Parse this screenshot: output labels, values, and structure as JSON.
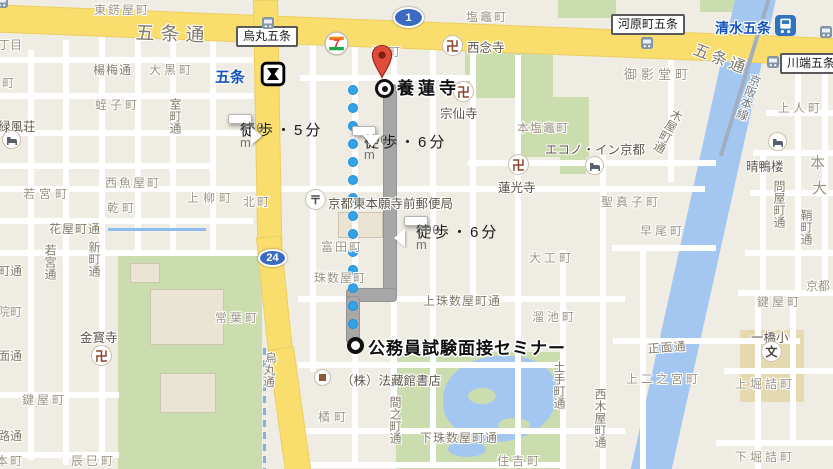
{
  "route": {
    "origin": {
      "label": "公務員試験面接セミナー",
      "x": 368,
      "y": 334
    },
    "destination": {
      "label": "養蓮寺",
      "x": 397,
      "y": 74
    },
    "walk_boxes": [
      {
        "duration": "徒歩・5分",
        "distance": "450 m",
        "x": 228,
        "y": 114,
        "ptr": "right"
      },
      {
        "duration": "徒歩・6分",
        "distance": "500 m",
        "x": 352,
        "y": 126,
        "ptr": "down"
      },
      {
        "duration": "徒歩・6分",
        "distance": "500 m",
        "x": 404,
        "y": 216,
        "ptr": "left"
      }
    ],
    "dots": {
      "x": 353,
      "y1": 90,
      "y2": 338,
      "step": 18
    },
    "gray_segments": [
      {
        "x": 383,
        "y": 84,
        "w": 14,
        "h": 216
      },
      {
        "x": 346,
        "y": 288,
        "w": 51,
        "h": 14
      },
      {
        "x": 346,
        "y": 296,
        "w": 14,
        "h": 48
      }
    ]
  },
  "map": {
    "road_shields": [
      {
        "num": "1",
        "x": 393,
        "y": 7,
        "w": 31,
        "h": 21
      },
      {
        "num": "24",
        "x": 258,
        "y": 249,
        "w": 29,
        "h": 18
      }
    ],
    "transit_labels": [
      {
        "t": "五条",
        "x": 215,
        "y": 66,
        "fs": 15
      },
      {
        "t": "清水五条",
        "x": 715,
        "y": 18,
        "fs": 14
      }
    ],
    "transit_boxes": [
      {
        "t": "烏丸五条",
        "x": 236,
        "y": 26
      },
      {
        "t": "河原町五条",
        "x": 611,
        "y": 14
      },
      {
        "t": "川端五条",
        "x": 780,
        "y": 53
      }
    ],
    "town_labels": [
      {
        "t": "東錺屋町",
        "x": 94,
        "y": 1,
        "ls": 2
      },
      {
        "t": "丁目",
        "x": -2,
        "y": 36
      },
      {
        "t": "町",
        "x": 2,
        "y": 74
      },
      {
        "t": "大黒町",
        "x": 149,
        "y": 61,
        "ls": 3
      },
      {
        "t": "蛭子町",
        "x": 95,
        "y": 96,
        "ls": 3
      },
      {
        "t": "津町",
        "x": 372,
        "y": 43,
        "ls": 4
      },
      {
        "t": "塩竈町",
        "x": 466,
        "y": 8,
        "ls": 2
      },
      {
        "t": "御影堂町",
        "x": 624,
        "y": 64,
        "fs": 13,
        "ls": 4
      },
      {
        "t": "上人町",
        "x": 778,
        "y": 99,
        "ls": 3
      },
      {
        "t": "本塩竈町",
        "x": 517,
        "y": 119,
        "ls": 1
      },
      {
        "t": "若宮町",
        "x": 23,
        "y": 185,
        "ls": 4
      },
      {
        "t": "西魚屋町",
        "x": 105,
        "y": 174,
        "ls": 2
      },
      {
        "t": "乾町",
        "x": 107,
        "y": 199,
        "ls": 3
      },
      {
        "t": "上柳町",
        "x": 187,
        "y": 189,
        "ls": 4
      },
      {
        "t": "北町",
        "x": 243,
        "y": 193,
        "ls": 2
      },
      {
        "t": "聖真子町",
        "x": 601,
        "y": 193,
        "ls": 3
      },
      {
        "t": "早尾町",
        "x": 640,
        "y": 222,
        "ls": 3
      },
      {
        "t": "大工町",
        "x": 529,
        "y": 249,
        "ls": 3
      },
      {
        "t": "富田町",
        "x": 321,
        "y": 238,
        "ls": 2
      },
      {
        "t": "珠数屋町",
        "x": 314,
        "y": 269,
        "ls": 1
      },
      {
        "t": "溜池町",
        "x": 532,
        "y": 308,
        "ls": 3
      },
      {
        "t": "常葉町",
        "x": 215,
        "y": 309,
        "ls": 3
      },
      {
        "t": "鍵屋町",
        "x": 22,
        "y": 391,
        "ls": 3
      },
      {
        "t": "院町",
        "x": -2,
        "y": 303
      },
      {
        "t": "辰巳町",
        "x": 71,
        "y": 452,
        "ls": 3
      },
      {
        "t": "本町",
        "x": -4,
        "y": 452,
        "ls": 2
      },
      {
        "t": "橘町",
        "x": 318,
        "y": 408,
        "ls": 4
      },
      {
        "t": "住吉町",
        "x": 497,
        "y": 452,
        "ls": 3
      },
      {
        "t": "上二之宮町",
        "x": 626,
        "y": 370,
        "ls": 3
      },
      {
        "t": "上堀詰町",
        "x": 735,
        "y": 375,
        "ls": 3
      },
      {
        "t": "下堀詰町",
        "x": 735,
        "y": 448,
        "ls": 3
      },
      {
        "t": "鍵屋町",
        "x": 757,
        "y": 293,
        "ls": 3
      },
      {
        "t": "京都",
        "x": 806,
        "y": 277
      },
      {
        "t": "本",
        "x": 810,
        "y": 152,
        "fs": 15
      },
      {
        "t": "大",
        "x": 812,
        "y": 177,
        "fs": 15
      }
    ],
    "street_labels": [
      {
        "t": "五条通",
        "x": 136,
        "y": 18,
        "fs": 19,
        "ls": 6,
        "r": 2
      },
      {
        "t": "五条通",
        "x": 699,
        "y": 36,
        "fs": 16,
        "ls": 3,
        "r": 21
      },
      {
        "t": "楊梅通",
        "x": 93,
        "y": 61,
        "ls": 1
      },
      {
        "t": "花屋町通",
        "x": 49,
        "y": 220,
        "ls": 1
      },
      {
        "t": "上珠数屋町通",
        "x": 423,
        "y": 292,
        "ls": 1
      },
      {
        "t": "下珠数屋町通",
        "x": 420,
        "y": 429,
        "ls": 1
      },
      {
        "t": "正面通",
        "x": 647,
        "y": 340,
        "ls": 1,
        "r": -4
      },
      {
        "t": "町通",
        "x": -2,
        "y": 262
      },
      {
        "t": "面通",
        "x": -2,
        "y": 347
      },
      {
        "t": "路通",
        "x": -2,
        "y": 427
      }
    ],
    "street_labels_vertical": [
      {
        "t": "室町通",
        "x": 167,
        "y": 98
      },
      {
        "t": "若宮通",
        "x": 42,
        "y": 244
      },
      {
        "t": "新町通",
        "x": 86,
        "y": 241
      },
      {
        "t": "烏丸通",
        "x": 263,
        "y": 351,
        "r": 5
      },
      {
        "t": "間之町通",
        "x": 387,
        "y": 396
      },
      {
        "t": "土手町通",
        "x": 551,
        "y": 361
      },
      {
        "t": "西木屋町通",
        "x": 592,
        "y": 388
      },
      {
        "t": "木屋町通",
        "x": 672,
        "y": 106,
        "r": 28
      },
      {
        "t": "問屋町通",
        "x": 771,
        "y": 180
      },
      {
        "t": "鞘町通",
        "x": 798,
        "y": 209
      },
      {
        "t": "京阪本線",
        "x": 749,
        "y": 72,
        "r": 20,
        "rail": true
      }
    ],
    "poi_labels": [
      {
        "t": "西念寺",
        "x": 467,
        "y": 37
      },
      {
        "t": "宗仙寺",
        "x": 440,
        "y": 103
      },
      {
        "t": "蓮光寺",
        "x": 498,
        "y": 177
      },
      {
        "t": "金寳寺",
        "x": 80,
        "y": 327
      },
      {
        "t": "エコノ・イン京都",
        "x": 545,
        "y": 139
      },
      {
        "t": "晴鴨楼",
        "x": 746,
        "y": 156
      },
      {
        "t": "緑風荘",
        "x": -2,
        "y": 116
      },
      {
        "t": "京都東本願寺前郵便局",
        "x": 328,
        "y": 193
      },
      {
        "t": "（株）法藏館書店",
        "x": 341,
        "y": 370
      },
      {
        "t": "一橋小",
        "x": 751,
        "y": 327
      }
    ],
    "icons": [
      {
        "k": "temple",
        "x": 442,
        "y": 35
      },
      {
        "k": "temple",
        "x": 453,
        "y": 81
      },
      {
        "k": "temple",
        "x": 508,
        "y": 154
      },
      {
        "k": "temple",
        "x": 91,
        "y": 345
      },
      {
        "k": "post",
        "x": 305,
        "y": 189
      },
      {
        "k": "hotel",
        "x": 2,
        "y": 130
      },
      {
        "k": "hotel",
        "x": 585,
        "y": 156
      },
      {
        "k": "hotel",
        "x": 768,
        "y": 132
      },
      {
        "k": "school",
        "x": 761,
        "y": 341
      },
      {
        "k": "store",
        "x": 314,
        "y": 369
      },
      {
        "k": "seven",
        "x": 324,
        "y": 31
      },
      {
        "k": "subway",
        "x": 260,
        "y": 61
      },
      {
        "k": "train",
        "x": 775,
        "y": 15
      },
      {
        "k": "bus",
        "x": 262,
        "y": 17
      },
      {
        "k": "bus",
        "x": 641,
        "y": 37
      },
      {
        "k": "bus",
        "x": 767,
        "y": 56
      },
      {
        "k": "bus",
        "x": 820,
        "y": 26
      },
      {
        "k": "bus",
        "x": -4,
        "y": -4
      }
    ],
    "colors": {
      "land": "#EFECE3",
      "road_major": "#F9DE6D",
      "road_minor": "#FFFFFF",
      "water": "#A3C7F0",
      "park": "#CBDCAE",
      "route_dot": "#35A1E8",
      "route_alt": "#A7A7A7",
      "transit_text": "#1553BC",
      "marker_pin": "#E04B3A"
    }
  }
}
